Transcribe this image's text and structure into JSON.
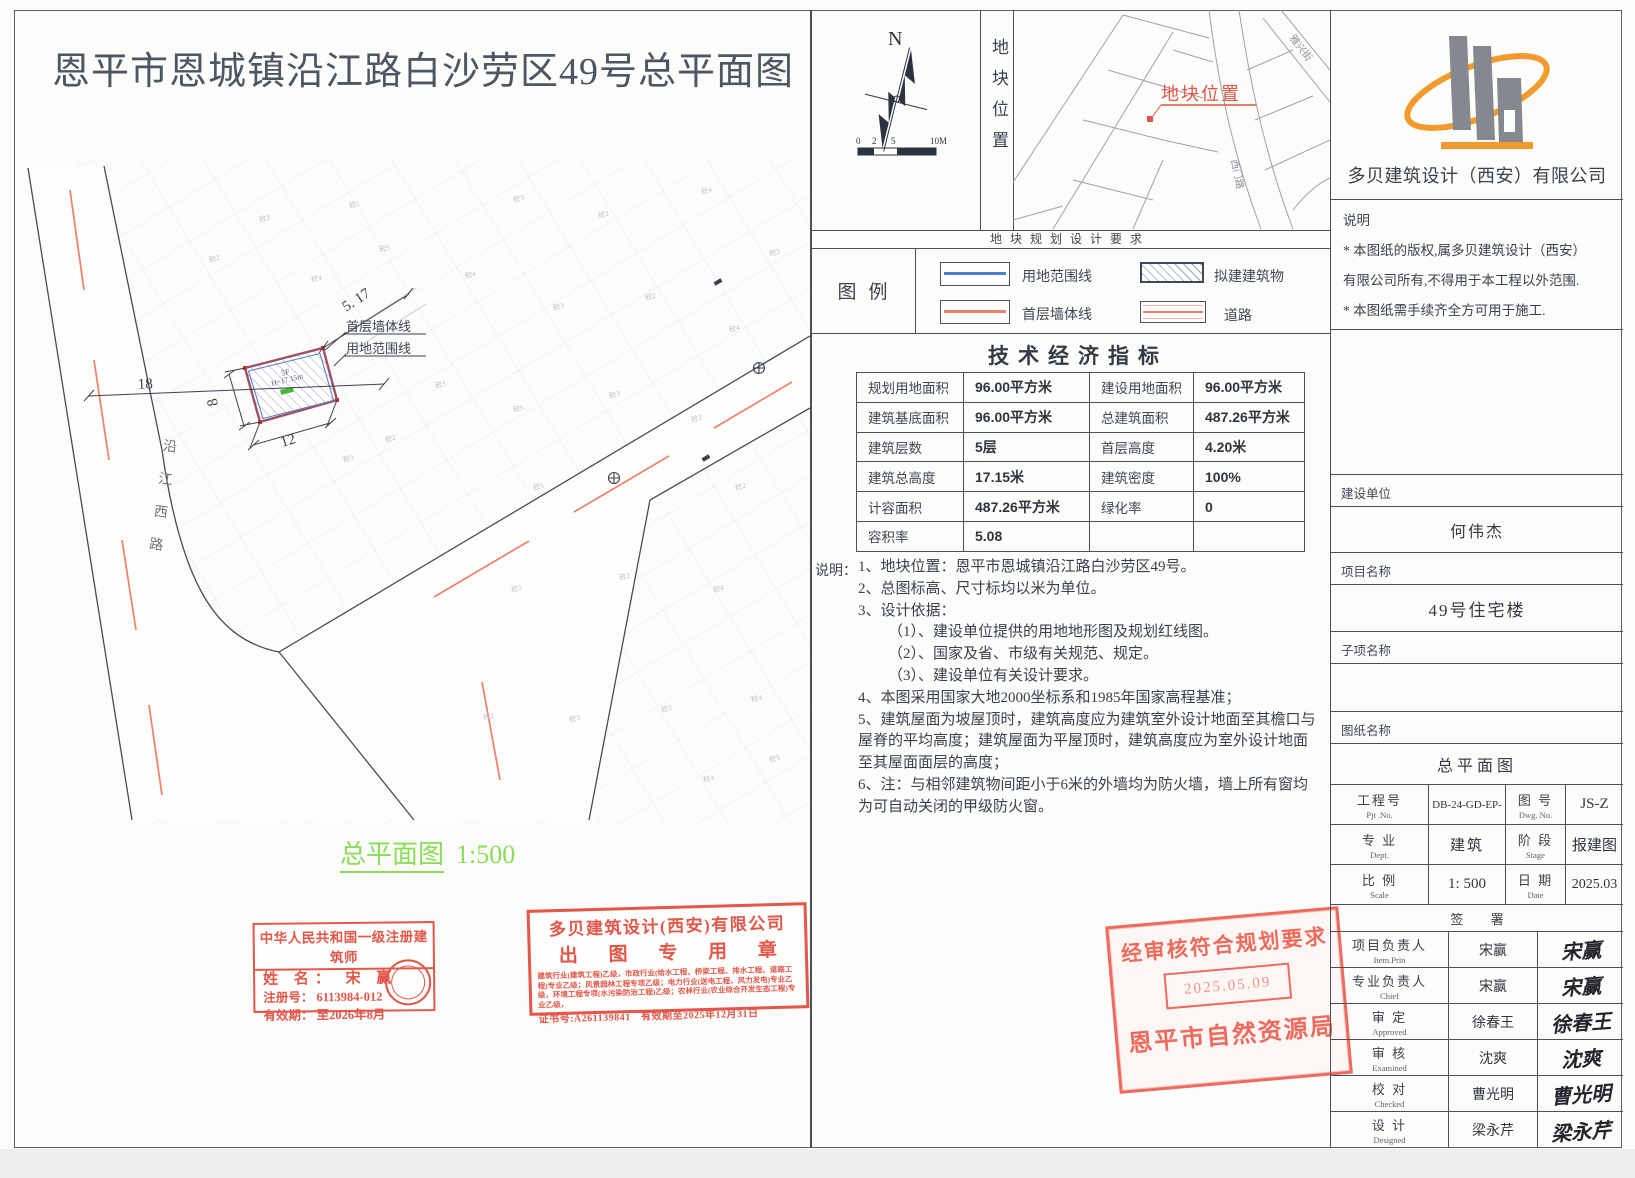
{
  "title": "恩平市恩城镇沿江路白沙劳区49号总平面图",
  "site_plan": {
    "road_name": "沿江西路",
    "dims": {
      "d18": "18",
      "d12": "12",
      "d8": "8",
      "d517": "5. 17"
    },
    "labels": {
      "wall_line": "首层墙体线",
      "boundary_line": "用地范围线"
    },
    "building": {
      "floors": "5F",
      "height": "H=17.15m"
    },
    "caption": "总平面图",
    "caption_scale": "1:500",
    "parcel_labels": [
      {
        "t": "砼3",
        "x": 500,
        "y": 42
      },
      {
        "t": "砼2",
        "x": 585,
        "y": 58
      },
      {
        "t": "砼4",
        "x": 688,
        "y": 34
      },
      {
        "t": "砼3",
        "x": 756,
        "y": 96
      },
      {
        "t": "砼4",
        "x": 452,
        "y": 118
      },
      {
        "t": "砼3",
        "x": 540,
        "y": 150
      },
      {
        "t": "砼2",
        "x": 632,
        "y": 140
      },
      {
        "t": "砼4",
        "x": 716,
        "y": 172
      },
      {
        "t": "砼3",
        "x": 422,
        "y": 228
      },
      {
        "t": "砼5",
        "x": 500,
        "y": 252
      },
      {
        "t": "砼3",
        "x": 596,
        "y": 238
      },
      {
        "t": "砼2",
        "x": 678,
        "y": 262
      },
      {
        "t": "砼2",
        "x": 372,
        "y": 282
      },
      {
        "t": "砼5",
        "x": 520,
        "y": 330
      },
      {
        "t": "砼2",
        "x": 722,
        "y": 330
      },
      {
        "t": "砼3",
        "x": 498,
        "y": 432
      },
      {
        "t": "砼2",
        "x": 606,
        "y": 420
      },
      {
        "t": "砼4",
        "x": 700,
        "y": 432
      },
      {
        "t": "砼3",
        "x": 556,
        "y": 562
      },
      {
        "t": "砼2",
        "x": 648,
        "y": 552
      },
      {
        "t": "砼4",
        "x": 738,
        "y": 542
      },
      {
        "t": "砼5",
        "x": 366,
        "y": 92
      },
      {
        "t": "砼1",
        "x": 336,
        "y": 48
      },
      {
        "t": "砼4",
        "x": 298,
        "y": 122
      },
      {
        "t": "砼3",
        "x": 246,
        "y": 62
      },
      {
        "t": "砼2",
        "x": 196,
        "y": 102
      },
      {
        "t": "砼3",
        "x": 330,
        "y": 302
      },
      {
        "t": "砼2",
        "x": 470,
        "y": 560
      },
      {
        "t": "砼5",
        "x": 756,
        "y": 602
      },
      {
        "t": "砼4",
        "x": 690,
        "y": 622
      }
    ]
  },
  "north_panel": {
    "n": "N",
    "scale_ticks": [
      "0",
      "2",
      "5",
      "10M"
    ]
  },
  "location_panel": {
    "vertical_label": "地块位置",
    "map_label": "地块位置",
    "road_name_1": "雅兴街",
    "road_name_2": "西门路"
  },
  "requirements_strip": "地块规划设计要求",
  "legend": {
    "title": "图例",
    "items": [
      {
        "label": "用地范围线"
      },
      {
        "label": "拟建建筑物"
      },
      {
        "label": "首层墙体线"
      },
      {
        "label": "道路"
      }
    ]
  },
  "indicators": {
    "title": "技术经济指标",
    "rows": [
      [
        "规划用地面积",
        "96.00平方米",
        "建设用地面积",
        "96.00平方米"
      ],
      [
        "建筑基底面积",
        "96.00平方米",
        "总建筑面积",
        "487.26平方米"
      ],
      [
        "建筑层数",
        "5层",
        "首层高度",
        "4.20米"
      ],
      [
        "建筑总高度",
        "17.15米",
        "建筑密度",
        "100%"
      ],
      [
        "计容面积",
        "487.26平方米",
        "绿化率",
        "0"
      ],
      [
        "容积率",
        "5.08",
        "",
        ""
      ]
    ]
  },
  "notes": {
    "label": "说明：",
    "lines": [
      {
        "t": "1、地块位置：恩平市恩城镇沿江路白沙劳区49号。"
      },
      {
        "t": "2、总图标高、尺寸标均以米为单位。"
      },
      {
        "t": "3、设计依据："
      },
      {
        "t": "（1）、建设单位提供的用地地形图及规划红线图。"
      },
      {
        "t": "（2）、国家及省、市级有关规范、规定。"
      },
      {
        "t": "（3）、建设单位有关设计要求。"
      },
      {
        "t": "4、本图采用国家大地2000坐标系和1985年国家高程基准；"
      },
      {
        "t": "5、建筑屋面为坡屋顶时，建筑高度应为建筑室外设计地面至其檐口与屋脊的平均高度；建筑屋面为平屋顶时，建筑高度应为室外设计地面至其屋面面层的高度；"
      },
      {
        "t": "6、注：与相邻建筑物间距小于6米的外墙均为防火墙，墙上所有窗均为可自动关闭的甲级防火窗。"
      }
    ]
  },
  "stamps": {
    "architect": {
      "title": "中华人民共和国一级注册建筑师",
      "name_row": "姓  名： 宋  赢",
      "reg_row": "注册号： 6113984-012",
      "valid_row": "有效期： 至2026年8月"
    },
    "company": {
      "line1": "多贝建筑设计(西安)有限公司",
      "line2": "出 图 专 用 章",
      "fine_print": "建筑行业(建筑工程)乙级，市政行业(给水工程、桥梁工程、排水工程、道路工程)专业乙级；风景园林工程专项乙级；电力行业(送电工程、风力发电)专业乙级，环境工程专项(水污染防治工程)乙级；农林行业(农业综合开发生态工程)专业乙级，",
      "cert": "证书号:A261139841　有效期至2025年12月31日"
    },
    "approval": {
      "line1": "经审核符合规划要求",
      "date": "2025.05.09",
      "line2": "恩平市自然资源局"
    }
  },
  "titleblock": {
    "company": "多贝建筑设计（西安）有限公司",
    "notice": {
      "head": "说明",
      "l1": "* 本图纸的版权,属多贝建筑设计（西安）",
      "l2": "有限公司所有,不得用于本工程以外范围.",
      "l3": "* 本图纸需手续齐全方可用于施工."
    },
    "fields": {
      "owner_label": "建设单位",
      "owner": "何伟杰",
      "project_label": "项目名称",
      "project": "49号住宅楼",
      "sub_label": "子项名称",
      "sub": "",
      "drawing_label": "图纸名称",
      "drawing": "总平面图"
    },
    "grid": {
      "pjt_cjk": "工程号",
      "pjt_en": "Pjt .No.",
      "pjt_val": "DB-24-GD-EP-",
      "dwg_cjk": "图 号",
      "dwg_en": "Dwg. No.",
      "dwg_val": "JS-Z",
      "dept_cjk": "专 业",
      "dept_en": "Dept.",
      "dept_val": "建筑",
      "stage_cjk": "阶 段",
      "stage_en": "Stage",
      "stage_val": "报建图",
      "scale_cjk": "比 例",
      "scale_en": "Scale",
      "scale_val": "1: 500",
      "date_cjk": "日 期",
      "date_en": "Date",
      "date_val": "2025.03"
    },
    "sign_header": "签 署",
    "signers": [
      {
        "role": "项目负责人",
        "role_en": "Item.Prin",
        "name": "宋赢",
        "sig": "宋赢"
      },
      {
        "role": "专业负责人",
        "role_en": "Chief",
        "name": "宋赢",
        "sig": "宋赢"
      },
      {
        "role": "审 定",
        "role_en": "Approved",
        "name": "徐春王",
        "sig": "徐春王"
      },
      {
        "role": "审 核",
        "role_en": "Examined",
        "name": "沈爽",
        "sig": "沈爽"
      },
      {
        "role": "校 对",
        "role_en": "Checked",
        "name": "曹光明",
        "sig": "曹光明"
      },
      {
        "role": "设 计",
        "role_en": "Designed",
        "name": "梁永芹",
        "sig": "梁永芹"
      }
    ]
  }
}
